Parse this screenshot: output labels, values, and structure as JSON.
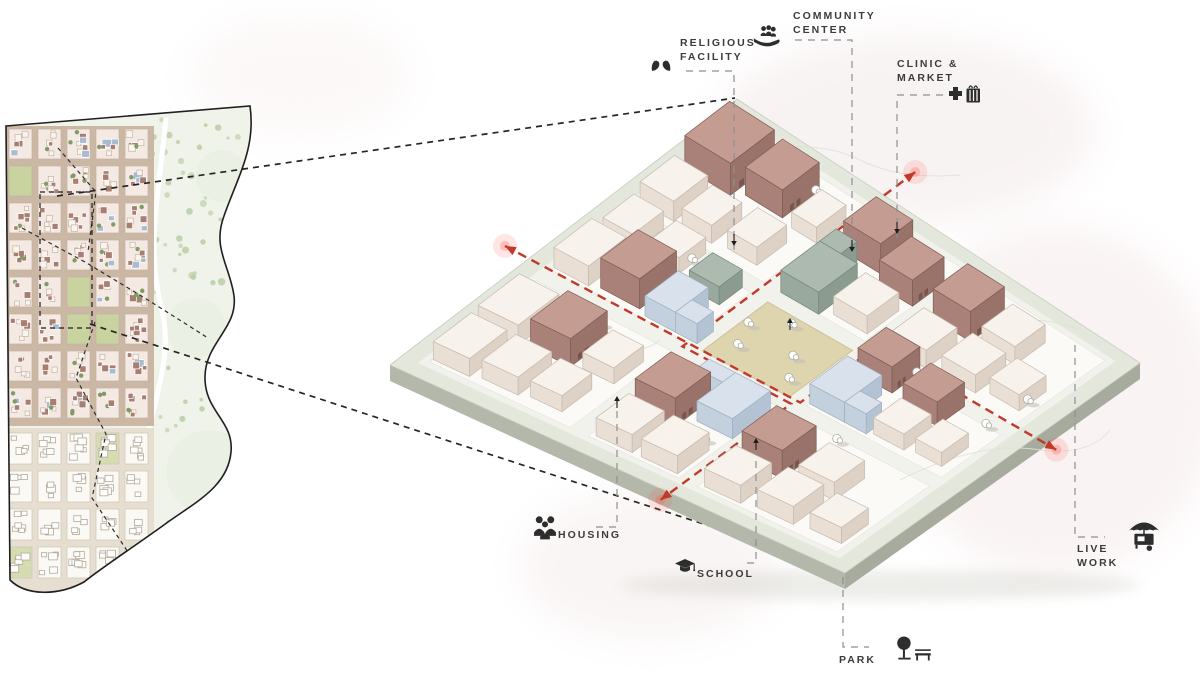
{
  "labels": {
    "religious_facility": {
      "line1": "RELIGIOUS",
      "line2": "FACILITY",
      "icon": "dove-hands-icon"
    },
    "community_center": {
      "line1": "COMMUNITY",
      "line2": "CENTER",
      "icon": "hand-people-icon"
    },
    "clinic_market": {
      "line1": "CLINIC &",
      "line2": "MARKET",
      "icon": "plus-basket-icon"
    },
    "housing": {
      "label": "HOUSING",
      "icon": "people-group-icon"
    },
    "school": {
      "label": "SCHOOL",
      "icon": "graduation-cap-icon"
    },
    "live_work": {
      "line1": "LIVE",
      "line2": "WORK",
      "icon": "food-cart-icon"
    },
    "park": {
      "label": "PARK",
      "icon": "tree-bench-icon"
    }
  },
  "colors": {
    "label_text": "#3c3c3c",
    "icon": "#2d2d2d",
    "leader": "#8f8f8f",
    "connector": "#262626",
    "route_red": "#c0392b",
    "glow_red": "#ff5040"
  },
  "background": {
    "blobs": [
      [
        905,
        130,
        190,
        95,
        "#f6eeee",
        0.7
      ],
      [
        1055,
        400,
        165,
        175,
        "#f7efee",
        0.7
      ],
      [
        650,
        565,
        130,
        75,
        "#f7f1f0",
        0.7
      ],
      [
        300,
        75,
        110,
        60,
        "#f9f4f3",
        0.6
      ]
    ]
  },
  "map": {
    "outline": "M6,126 L250,106 C256,148 238,176 224,216 C212,248 230,266 234,296 C238,328 206,342 205,376 C204,412 234,420 231,452 C228,486 196,502 168,522 C138,544 104,566 84,582 C58,596 26,596 10,580 Z",
    "palette": {
      "park_base": "#f0f3e9",
      "park_dot_a": "#c6d6b5",
      "park_dot_b": "#b9cda6",
      "clearing": "#ebf0e4",
      "road": "#ffffff",
      "urban_street": "#cbb8a4",
      "block_fill": "#f5e9e4",
      "block_stroke": "#c4b2a0",
      "bldg_mauve": "#a87e70",
      "bldg_cream": "#faf4ee",
      "bldg_cream_stroke": "#c5b4a4",
      "bldg_blue": "#a9bbcf",
      "green_court": "#c8d3a0",
      "tree_dot": "#7f9c63",
      "lower_street": "#e6ded0",
      "lower_block": "#fbf9f4",
      "lower_stroke": "#cdc5b6",
      "lower_bldg_stroke": "#b2aa9b",
      "lower_green": "#d6dcb2",
      "outline_stroke": "#1f1f1f"
    },
    "urban_zone": {
      "x": 8,
      "y": 128,
      "cols": [
        8,
        37,
        66,
        95,
        124
      ],
      "col_w": 25,
      "rows": [
        128,
        165,
        202,
        239,
        276,
        313,
        350,
        387
      ],
      "row_h": 32
    },
    "lower_zone": {
      "rows": [
        432,
        470,
        508,
        546
      ],
      "row_h": 33
    },
    "clearings": [
      [
        208,
        472,
        42
      ],
      [
        196,
        328,
        30
      ],
      [
        222,
        176,
        26
      ]
    ],
    "road_path": "M166,118 C158,200 146,250 162,310 C174,360 150,410 142,462 C136,504 118,540 98,572",
    "routes": [
      [
        [
          22,
          228
        ],
        [
          85,
          262
        ],
        [
          148,
          300
        ],
        [
          208,
          338
        ]
      ],
      [
        [
          58,
          148
        ],
        [
          96,
          192
        ],
        [
          88,
          252
        ]
      ],
      [
        [
          95,
          322
        ],
        [
          76,
          378
        ],
        [
          106,
          434
        ],
        [
          92,
          498
        ],
        [
          128,
          552
        ]
      ]
    ],
    "highlight_rect": [
      40,
      192,
      52,
      136
    ],
    "connectors": [
      [
        [
          57,
          196
        ],
        [
          735,
          98
        ]
      ],
      [
        [
          90,
          324
        ],
        [
          860,
          575
        ]
      ]
    ]
  },
  "axon": {
    "corners": {
      "L": [
        390,
        365
      ],
      "T": [
        737,
        99
      ],
      "R": [
        1140,
        363
      ],
      "B": [
        845,
        573
      ]
    },
    "thickness": 16,
    "rim_fill": "#e4e7dc",
    "rim_stroke": "#c9cdbf",
    "inner_fill": "#f2f2ec",
    "side_sw": "#b3b8ab",
    "side_se": "#a6ab9e",
    "cell_fill": "#fbfaf7",
    "cell_stroke": "#e6e6dd",
    "plaza_fill": "#ded4ae",
    "plaza_stroke": "#ccc096",
    "bands": [
      [
        0.05,
        0.36
      ],
      [
        0.4,
        0.6
      ],
      [
        0.64,
        0.95
      ]
    ],
    "palette": {
      "c": {
        "top": "#f8f2ec",
        "sw": "#eadfd5",
        "se": "#ded1c6",
        "stroke": "#c6bbaf"
      },
      "m": {
        "top": "#c59c92",
        "sw": "#aa8178",
        "se": "#99736a",
        "stroke": "#7e5c54"
      },
      "b": {
        "top": "#d8e1ec",
        "sw": "#c3d0de",
        "se": "#b4c3d4",
        "stroke": "#9fafc2"
      },
      "g": {
        "top": "#adbab0",
        "sw": "#9aa99e",
        "se": "#8c9b8f",
        "stroke": "#77877b"
      }
    },
    "buildings": [
      [
        "c",
        0.06,
        0.05,
        0.11,
        0.08,
        18
      ],
      [
        "c",
        0.19,
        0.05,
        0.12,
        0.09,
        20
      ],
      [
        "m",
        0.2,
        0.16,
        0.11,
        0.09,
        28
      ],
      [
        "c",
        0.07,
        0.15,
        0.1,
        0.08,
        18
      ],
      [
        "c",
        0.08,
        0.25,
        0.09,
        0.07,
        16
      ],
      [
        "c",
        0.21,
        0.27,
        0.09,
        0.07,
        16
      ],
      [
        "c",
        0.41,
        0.05,
        0.11,
        0.08,
        20
      ],
      [
        "c",
        0.54,
        0.06,
        0.09,
        0.07,
        18
      ],
      [
        "m",
        0.42,
        0.15,
        0.11,
        0.09,
        30
      ],
      [
        "c",
        0.55,
        0.16,
        0.08,
        0.07,
        16
      ],
      [
        "b",
        0.41,
        0.26,
        0.1,
        0.07,
        20
      ],
      [
        "b",
        0.41,
        0.33,
        0.05,
        0.05,
        20
      ],
      [
        "g",
        0.53,
        0.27,
        0.07,
        0.07,
        18
      ],
      [
        "c",
        0.66,
        0.05,
        0.1,
        0.08,
        20
      ],
      [
        "m",
        0.79,
        0.05,
        0.13,
        0.11,
        32
      ],
      [
        "c",
        0.66,
        0.15,
        0.09,
        0.07,
        18
      ],
      [
        "m",
        0.81,
        0.18,
        0.11,
        0.09,
        28
      ],
      [
        "c",
        0.67,
        0.25,
        0.09,
        0.07,
        18
      ],
      [
        "c",
        0.8,
        0.3,
        0.09,
        0.06,
        16
      ],
      [
        "c",
        0.06,
        0.41,
        0.1,
        0.08,
        18
      ],
      [
        "m",
        0.18,
        0.41,
        0.11,
        0.09,
        28
      ],
      [
        "c",
        0.06,
        0.51,
        0.1,
        0.08,
        18
      ],
      [
        "b",
        0.22,
        0.52,
        0.12,
        0.08,
        20
      ],
      [
        "b",
        0.3,
        0.46,
        0.04,
        0.06,
        20
      ],
      [
        "g",
        0.64,
        0.4,
        0.12,
        0.09,
        22
      ],
      [
        "g",
        0.76,
        0.4,
        0.05,
        0.05,
        22
      ],
      [
        "m",
        0.82,
        0.41,
        0.1,
        0.09,
        30
      ],
      [
        "c",
        0.66,
        0.51,
        0.1,
        0.08,
        18
      ],
      [
        "m",
        0.79,
        0.52,
        0.1,
        0.08,
        26
      ],
      [
        "c",
        0.06,
        0.65,
        0.1,
        0.08,
        18
      ],
      [
        "m",
        0.18,
        0.65,
        0.11,
        0.09,
        28
      ],
      [
        "c",
        0.07,
        0.76,
        0.1,
        0.08,
        18
      ],
      [
        "c",
        0.19,
        0.77,
        0.1,
        0.08,
        18
      ],
      [
        "c",
        0.08,
        0.87,
        0.09,
        0.07,
        16
      ],
      [
        "b",
        0.41,
        0.64,
        0.12,
        0.08,
        20
      ],
      [
        "b",
        0.41,
        0.72,
        0.05,
        0.05,
        20
      ],
      [
        "m",
        0.55,
        0.65,
        0.09,
        0.08,
        26
      ],
      [
        "c",
        0.42,
        0.78,
        0.09,
        0.07,
        16
      ],
      [
        "m",
        0.53,
        0.77,
        0.09,
        0.08,
        24
      ],
      [
        "c",
        0.43,
        0.87,
        0.09,
        0.06,
        14
      ],
      [
        "c",
        0.66,
        0.65,
        0.1,
        0.08,
        18
      ],
      [
        "m",
        0.79,
        0.65,
        0.11,
        0.09,
        30
      ],
      [
        "c",
        0.67,
        0.76,
        0.1,
        0.08,
        18
      ],
      [
        "c",
        0.8,
        0.76,
        0.1,
        0.08,
        18
      ],
      [
        "c",
        0.69,
        0.86,
        0.09,
        0.07,
        16
      ]
    ],
    "trees": [
      [
        0.31,
        0.115
      ],
      [
        0.335,
        0.215
      ],
      [
        0.615,
        0.115
      ],
      [
        0.595,
        0.225
      ],
      [
        0.91,
        0.27
      ],
      [
        0.455,
        0.44
      ],
      [
        0.52,
        0.415
      ],
      [
        0.5,
        0.535
      ],
      [
        0.575,
        0.475
      ],
      [
        0.44,
        0.57
      ],
      [
        0.37,
        0.49
      ],
      [
        0.85,
        0.55
      ],
      [
        0.885,
        0.575
      ],
      [
        0.63,
        0.73
      ],
      [
        0.3,
        0.7
      ],
      [
        0.35,
        0.745
      ],
      [
        0.6,
        0.915
      ],
      [
        0.725,
        0.925
      ],
      [
        0.18,
        0.565
      ]
    ],
    "red_paths": [
      [
        [
          0.4,
          -0.055
        ],
        [
          0.4,
          0.625
        ],
        [
          0.645,
          0.625
        ],
        [
          0.645,
          1.05
        ]
      ],
      [
        [
          1.095,
          0.365
        ],
        [
          0.385,
          0.365
        ],
        [
          0.385,
          0.615
        ],
        [
          -0.03,
          0.615
        ]
      ]
    ],
    "contours": [
      "M430,360 Q520,330 585,345 Q640,358 660,340",
      "M900,480 Q980,440 1040,450 Q1090,456 1110,430",
      "M760,150 Q820,140 860,160 Q900,180 960,175",
      "M980,330 Q1030,310 1080,330"
    ],
    "leaders": {
      "religious_facility": [
        [
          686,
          71
        ],
        [
          734,
          71
        ],
        [
          734,
          250
        ]
      ],
      "community_center": [
        [
          795,
          40
        ],
        [
          852,
          40
        ],
        [
          852,
          256
        ]
      ],
      "clinic_market": [
        [
          943,
          95
        ],
        [
          897,
          95
        ],
        [
          897,
          238
        ]
      ],
      "housing": [
        [
          596,
          527
        ],
        [
          617,
          527
        ],
        [
          617,
          400
        ]
      ],
      "school": [
        [
          747,
          563
        ],
        [
          756,
          563
        ],
        [
          756,
          442
        ]
      ],
      "park": [
        [
          843,
          577
        ],
        [
          843,
          647
        ],
        [
          869,
          647
        ]
      ],
      "live_work": [
        [
          1075,
          345
        ],
        [
          1075,
          537
        ],
        [
          1105,
          537
        ]
      ]
    },
    "leader_arrows": [
      [
        734,
        246,
        "down"
      ],
      [
        852,
        252,
        "down"
      ],
      [
        897,
        234,
        "down"
      ],
      [
        617,
        396,
        "up"
      ],
      [
        756,
        438,
        "up"
      ],
      [
        790,
        318,
        "up"
      ]
    ]
  }
}
